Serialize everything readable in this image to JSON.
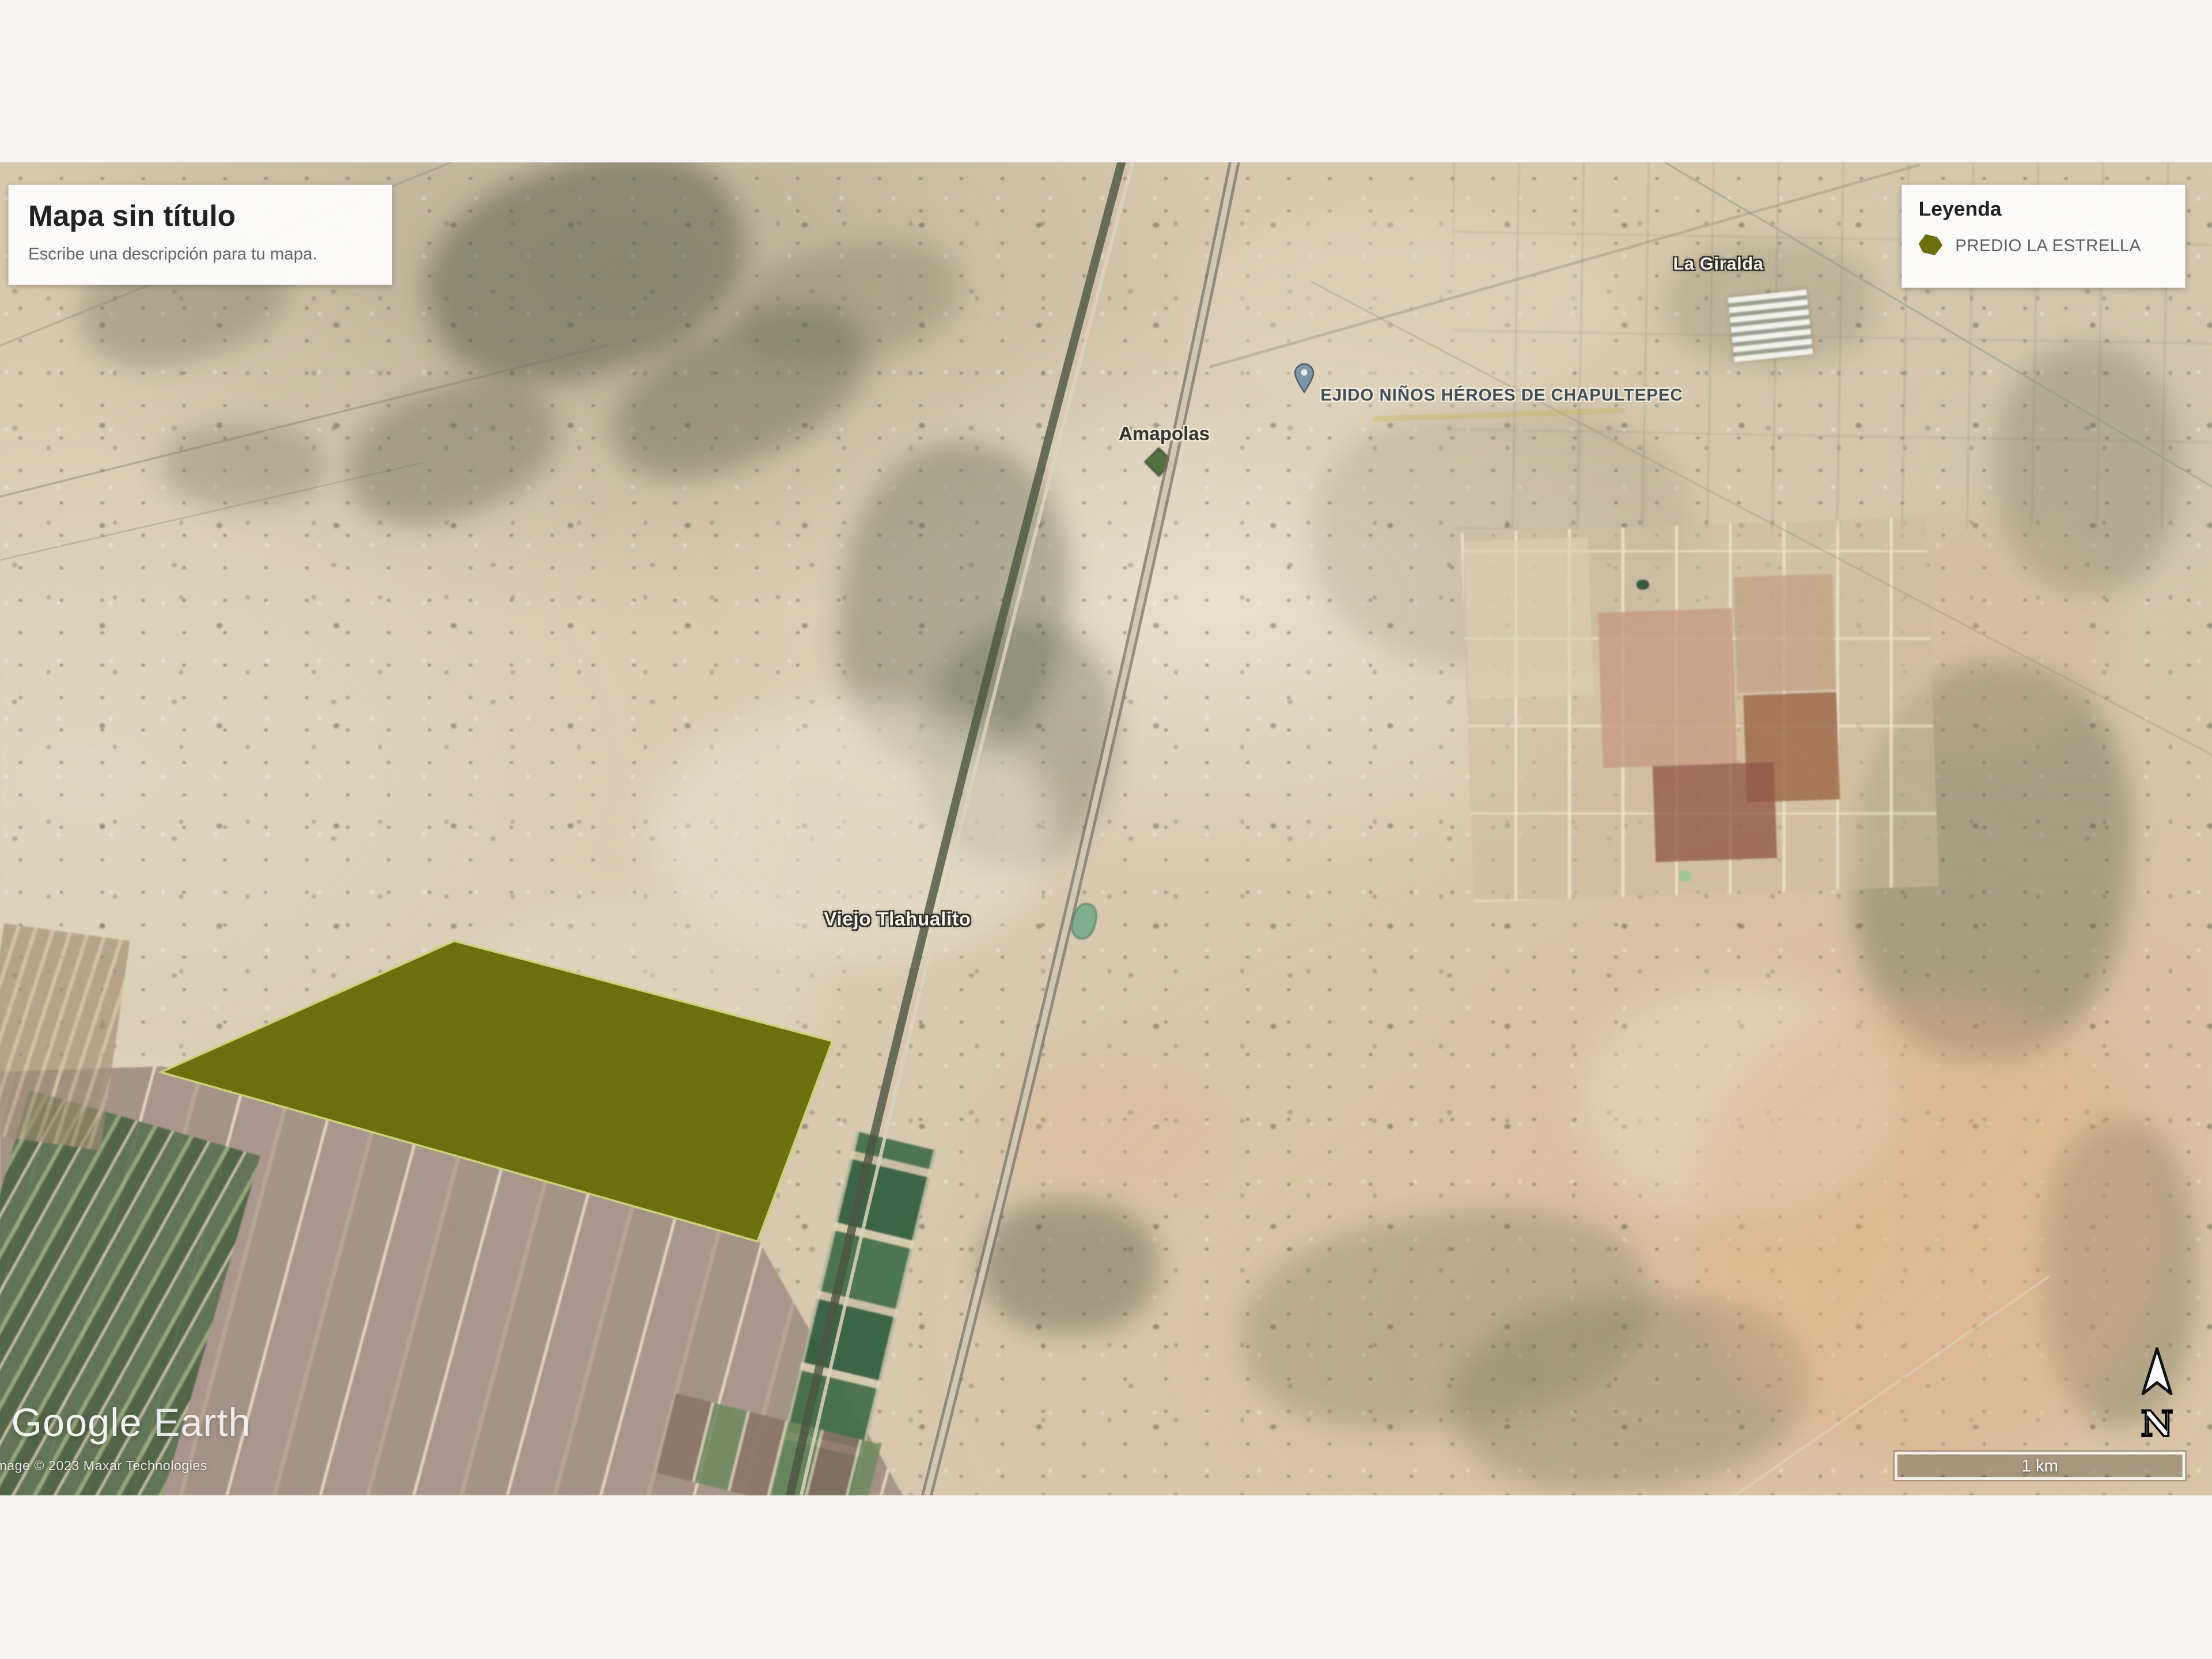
{
  "overlay": {
    "title_card": {
      "title": "Mapa sin título",
      "description": "Escribe una descripción para tu mapa."
    },
    "legend": {
      "title": "Leyenda",
      "item_label": "PREDIO LA ESTRELLA",
      "item_color": "#6c6f0d"
    }
  },
  "map": {
    "labels": {
      "la_giralda": "La Giralda",
      "ejido": "EJIDO NIÑOS HÉROES DE CHAPULTEPEC",
      "amapolas": "Amapolas",
      "viejo_tlahualito": "Viejo Tlahualito"
    },
    "feature": {
      "name": "PREDIO LA ESTRELLA",
      "fill": "#6c6f0d",
      "stroke": "#cdd17c"
    }
  },
  "attribution": {
    "brand_google": "Google",
    "brand_earth": "Earth",
    "copyright": "Image © 2023 Maxar Technologies"
  },
  "controls": {
    "scale_label": "1 km",
    "compass_label": "N"
  }
}
